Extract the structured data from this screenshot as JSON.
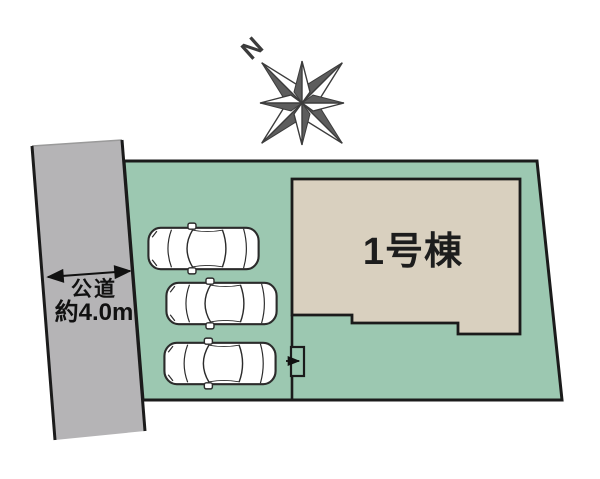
{
  "plan": {
    "type": "site-plan",
    "compass": {
      "north_label": "N"
    },
    "road": {
      "label_line1": "公道",
      "label_line2": "約4.0m",
      "width_note": "約4.0m"
    },
    "building": {
      "label": "1号棟"
    },
    "parking": {
      "car_count": 3
    }
  },
  "colors": {
    "plot_green": "#9cc8b1",
    "road_gray": "#b5b4b6",
    "building_beige": "#d9d0bf",
    "outline": "#1b1b1b",
    "compass_dark": "#5d5d5d",
    "car_body": "#ffffff"
  }
}
